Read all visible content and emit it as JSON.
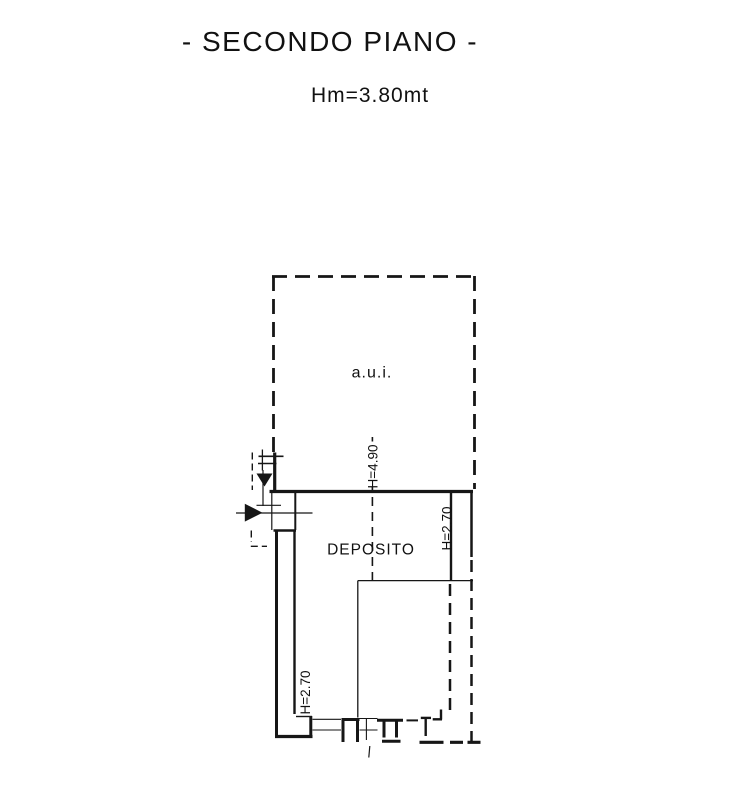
{
  "colors": {
    "line": "#161616",
    "text": "#111111",
    "background": "#ffffff"
  },
  "header": {
    "title": "- SECONDO PIANO -",
    "subtitle": "Hm=3.80mt"
  },
  "plan": {
    "rooms": [
      {
        "label": "a.u.i."
      },
      {
        "label": "DEPOSITO"
      }
    ],
    "height_labels": [
      {
        "text": "H=4.90"
      },
      {
        "text": "H=2.70"
      },
      {
        "text": "H=2.70"
      }
    ]
  }
}
